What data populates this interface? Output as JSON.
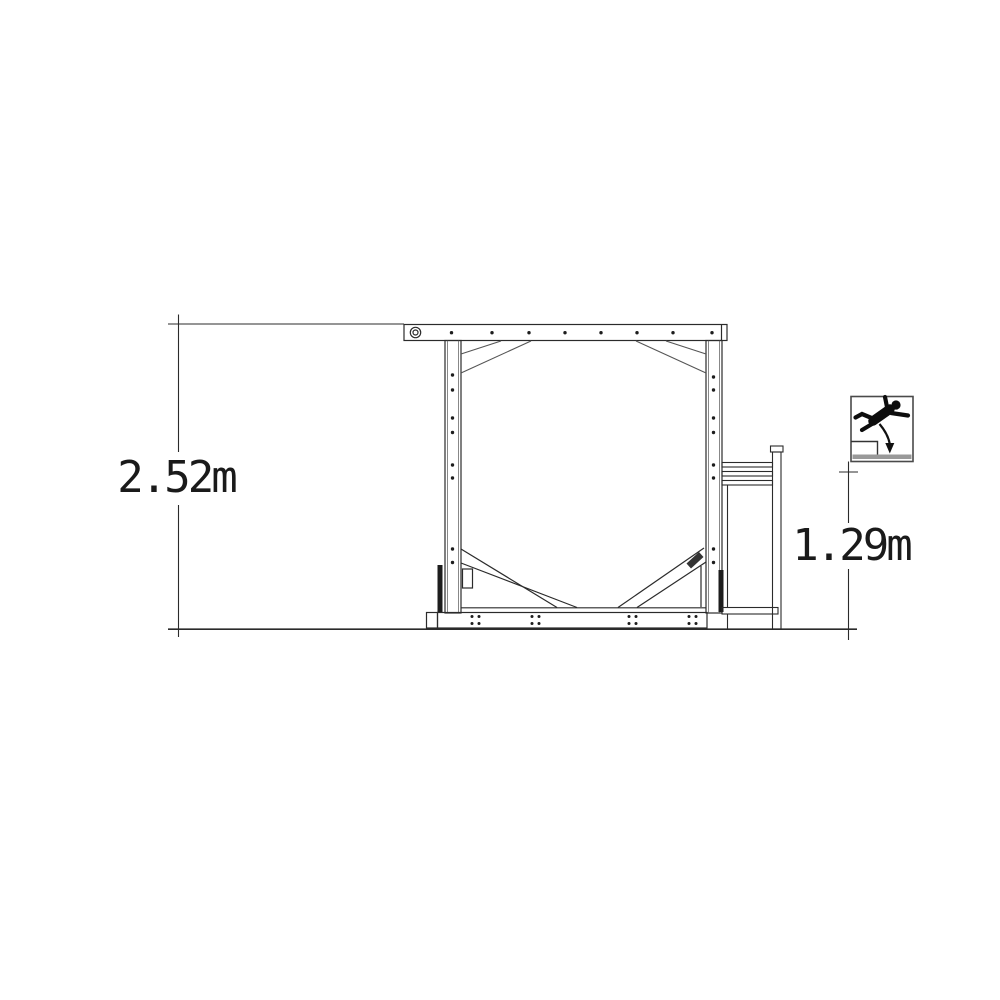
{
  "page": {
    "background": "#ffffff"
  },
  "drawing": {
    "type": "technical-side-elevation",
    "line_color": "#2b2b2b",
    "dark_fill": "#1d1d1d",
    "icon_ground_color": "#999999",
    "dimensions": {
      "overall_height": {
        "label": "2.52m",
        "orientation": "vertical"
      },
      "fall_height": {
        "label": "1.29m",
        "orientation": "vertical"
      }
    },
    "icons": {
      "fall_height": "fall-height-pictogram"
    }
  }
}
